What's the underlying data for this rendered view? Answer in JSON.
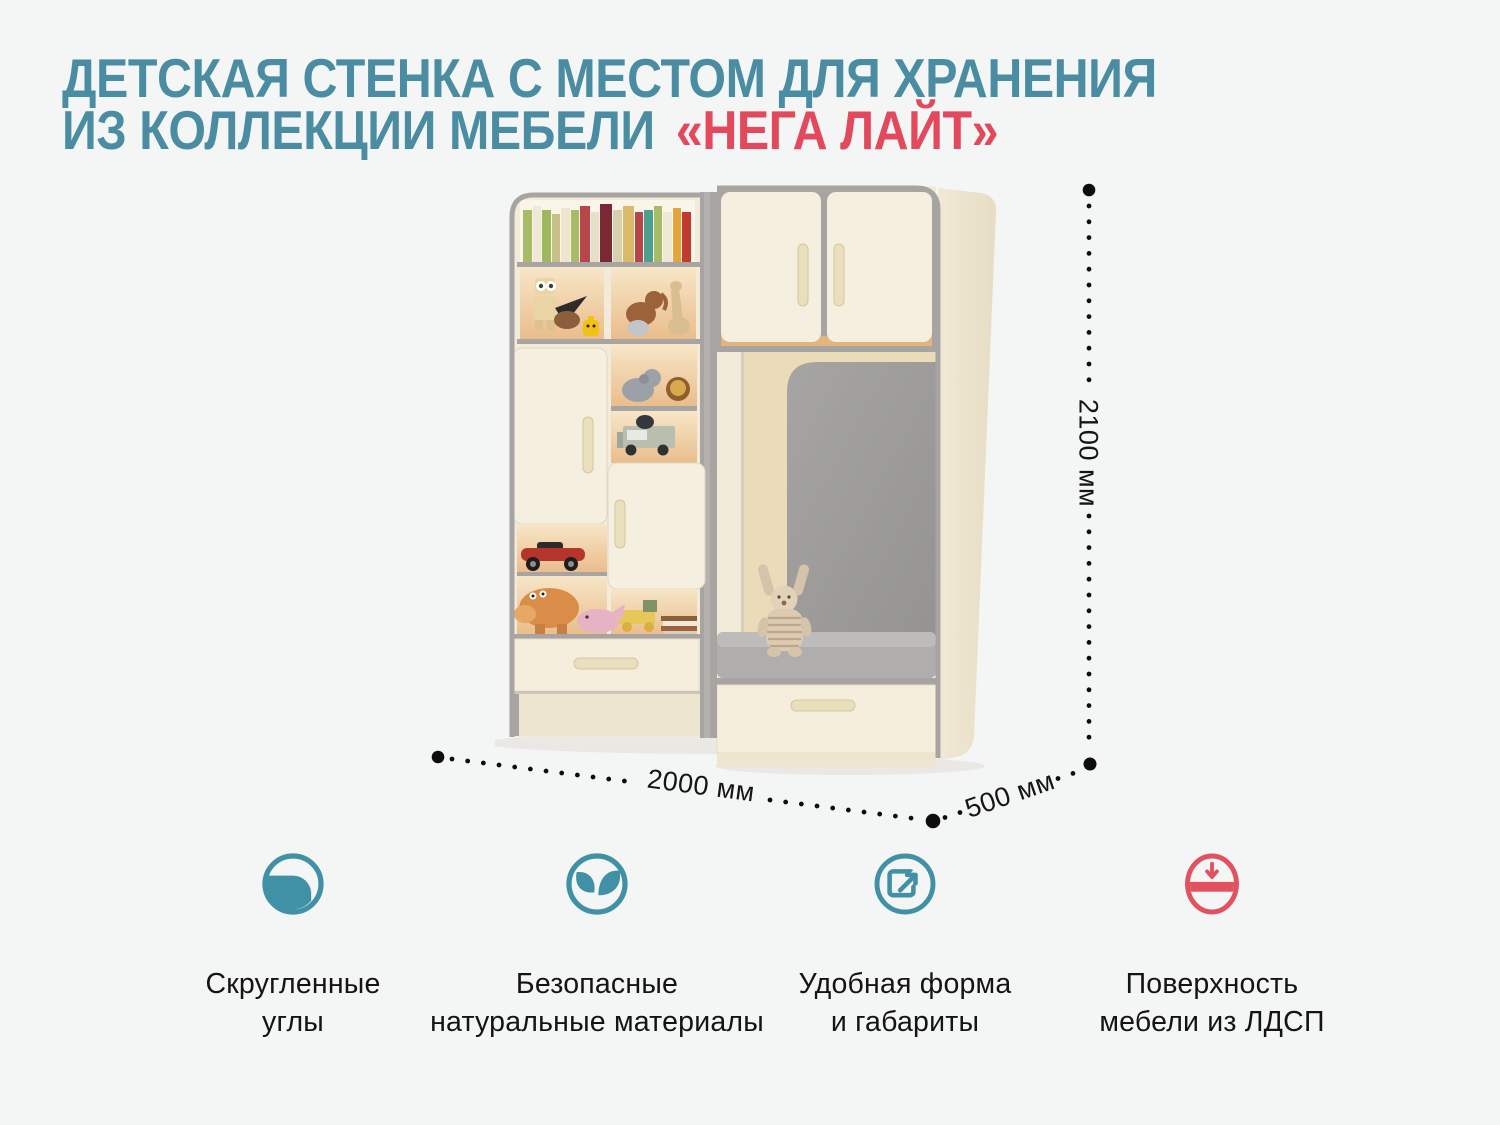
{
  "page": {
    "background": "#f4f5f5"
  },
  "title": {
    "line1": "ДЕТСКАЯ СТЕНКА С МЕСТОМ ДЛЯ ХРАНЕНИЯ",
    "line2_prefix": "ИЗ КОЛЛЕКЦИИ МЕБЕЛИ",
    "line2_accent": "«НЕГА ЛАЙТ»",
    "teal_color": "#4a8ca1",
    "red_color": "#e2495d"
  },
  "dimensions": {
    "height_label": "2100 мм",
    "width_label": "2000 мм",
    "depth_label": "500 мм"
  },
  "features": [
    {
      "icon": "rounded-corner-icon",
      "color": "#4090a6",
      "line1": "Скругленные",
      "line2": "углы"
    },
    {
      "icon": "leaves-icon",
      "color": "#4090a6",
      "line1": "Безопасные",
      "line2": "натуральные материалы"
    },
    {
      "icon": "expand-arrow-icon",
      "color": "#4090a6",
      "line1": "Удобная форма",
      "line2": "и габариты"
    },
    {
      "icon": "ldsp-surface-icon",
      "color": "#e25160",
      "line1": "Поверхность",
      "line2": "мебели из ЛДСП"
    }
  ]
}
